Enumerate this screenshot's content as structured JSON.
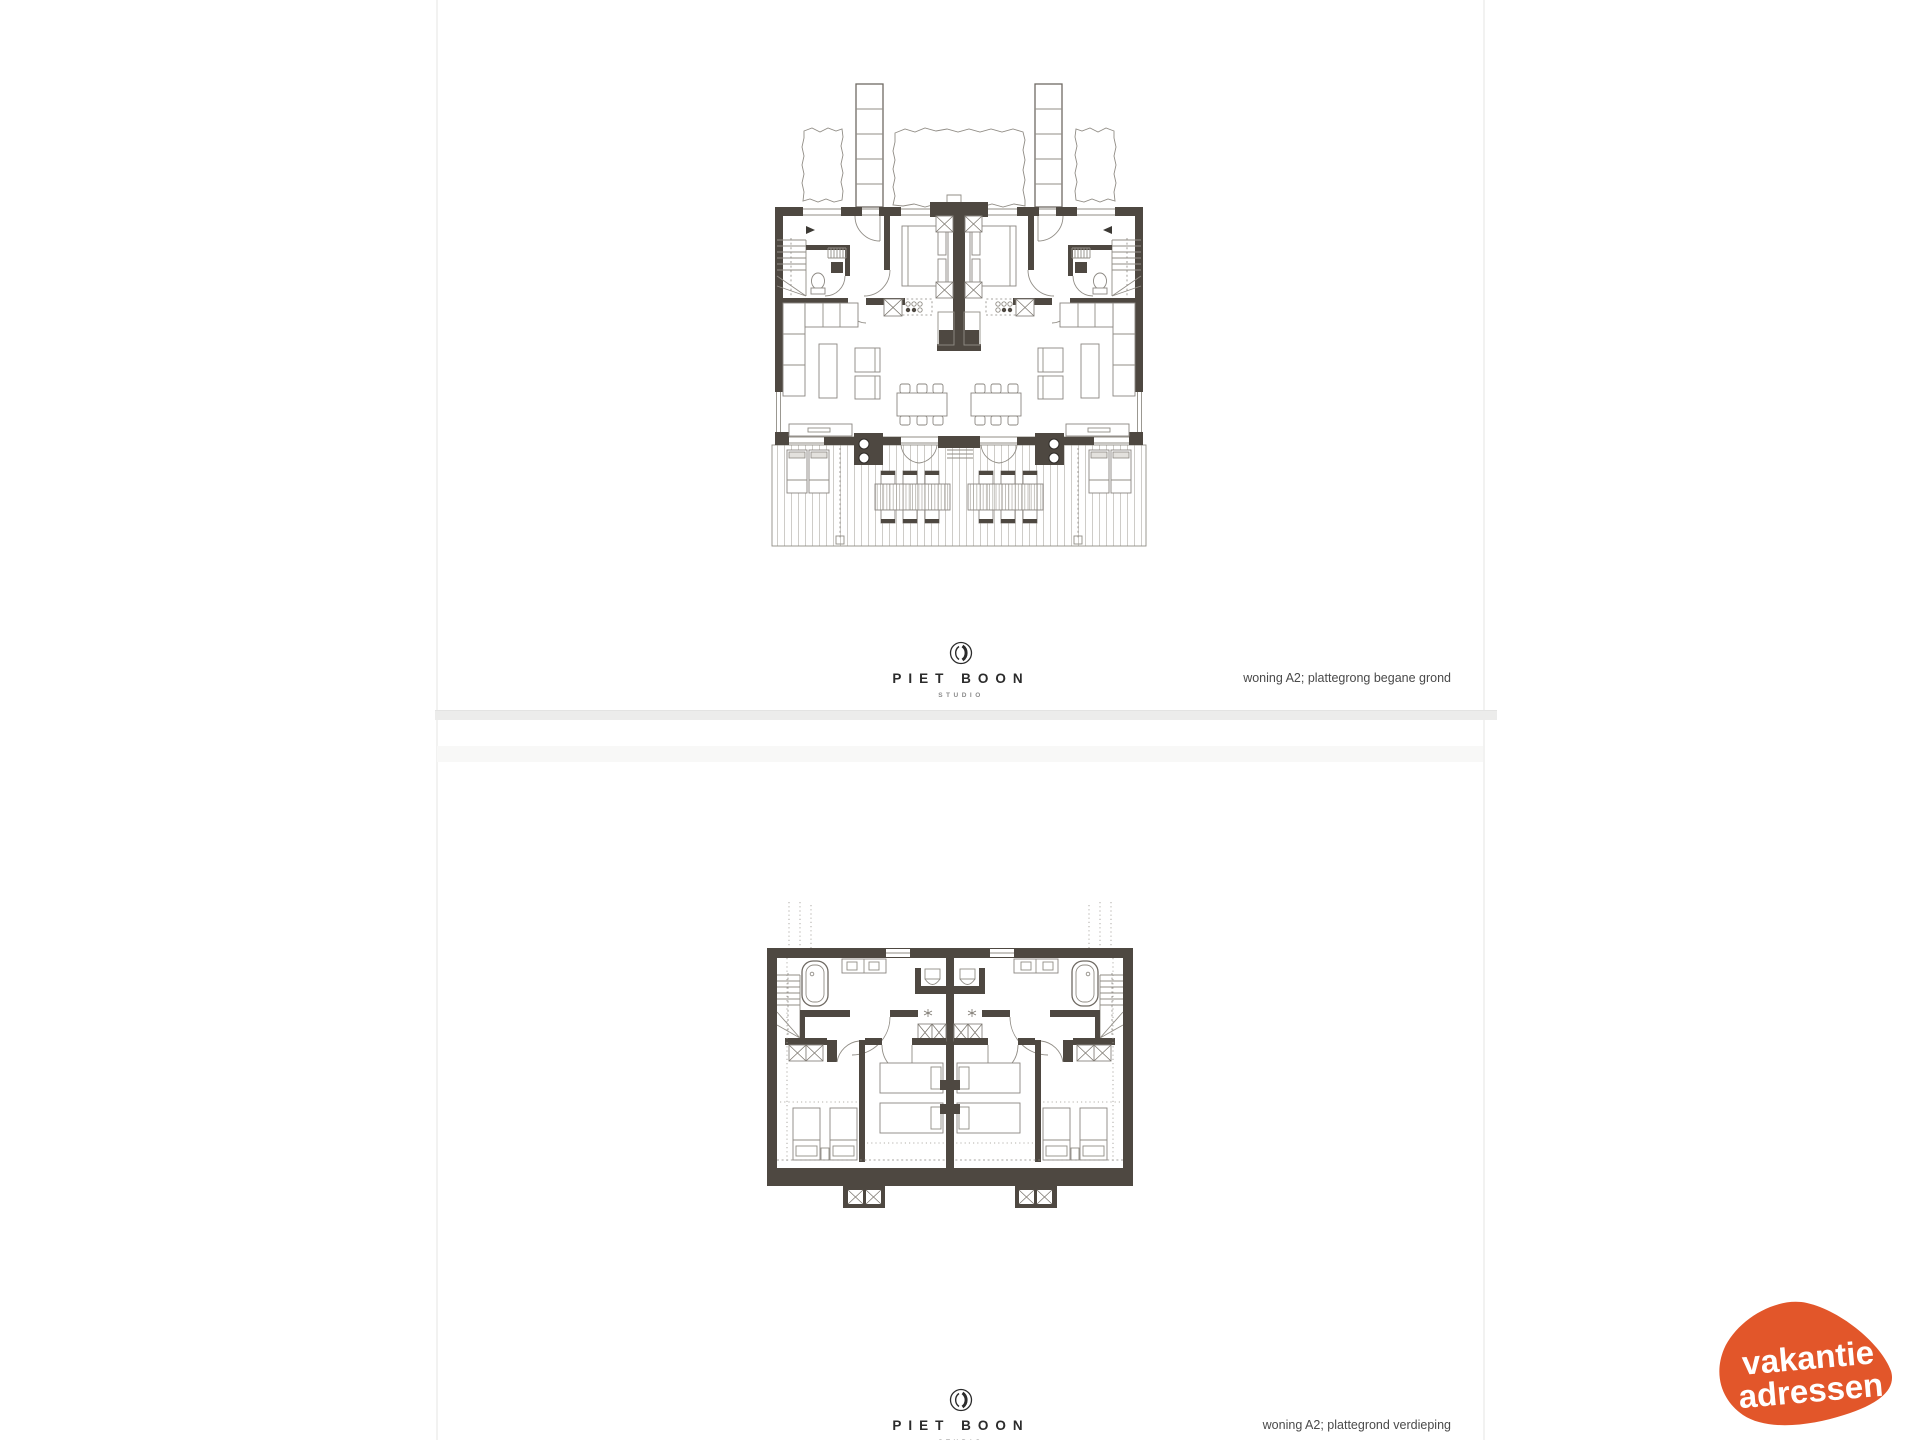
{
  "pages": [
    {
      "caption": "woning A2; plattegrong begane grond"
    },
    {
      "caption": "woning A2; plattegrond verdieping"
    }
  ],
  "studio": {
    "wordmark": "PIET BOON",
    "sub": "STUDIO"
  },
  "watermark": {
    "line1": "vakantie",
    "line2": "adressen",
    "bg": "#e2562a",
    "text_color": "#ffffff"
  },
  "palette": {
    "wall": "#4e4841",
    "thin_line": "#918d86",
    "plank_line": "#c2bfba",
    "divider_strip": "#ececeb",
    "caption_text": "#4a4a4a",
    "logo_text": "#2b2b2b",
    "logo_sub_text": "#8a8a8a"
  }
}
